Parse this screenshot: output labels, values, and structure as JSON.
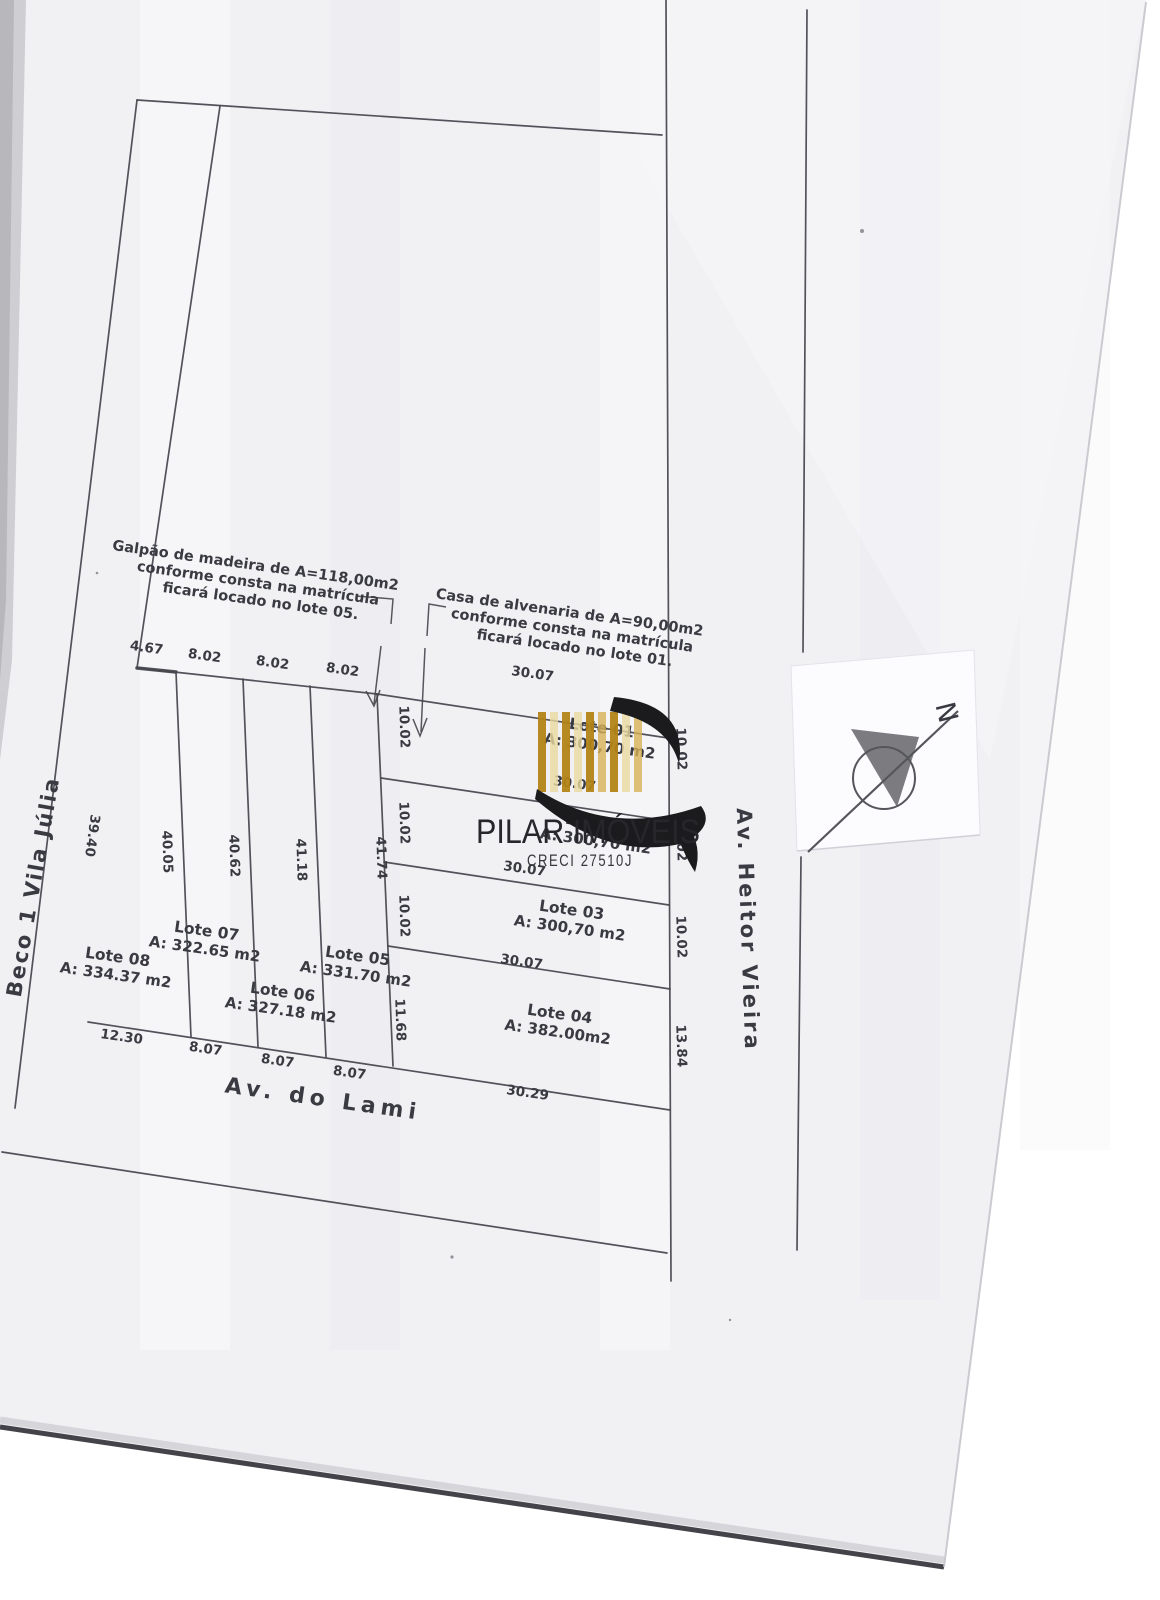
{
  "colors": {
    "paper": "#f1f1f4",
    "ink": "#45454d",
    "text_ink": "#3a3a42",
    "logo_black": "#1b1b1e",
    "gold_dark": "#b28316",
    "gold_mid": "#d7b258",
    "gold_pale": "#ead99f",
    "slip_white": "#fcfcff",
    "page_edge_dark": "#45434a",
    "compass_stroke": "#55555c"
  },
  "logo": {
    "title": "PILAR IMÓVEIS",
    "subtitle": "CRECI 27510J",
    "bar_colors": [
      "#b28316",
      "#ead99f",
      "#b28316",
      "#ead99f",
      "#b28316",
      "#d7b258",
      "#b28316",
      "#ead99f",
      "#d7b258"
    ]
  },
  "north": {
    "label": "N"
  },
  "streets": [
    {
      "id": "street-beco",
      "name": "Beco 1 Vila Júlia",
      "x": 40,
      "y": 888,
      "rot": -80,
      "size": 21,
      "ls": 2
    },
    {
      "id": "street-lami",
      "name": "Av. do Lami",
      "x": 322,
      "y": 1106,
      "rot": 8,
      "size": 22,
      "ls": 5
    },
    {
      "id": "street-heitor",
      "name": "Av. Heitor Vieira",
      "x": 741,
      "y": 930,
      "rot": 88,
      "size": 21,
      "ls": 3
    }
  ],
  "annotations": [
    {
      "id": "note-galpao",
      "lines": [
        "Galpão de madeira de A=118,00m2",
        "conforme consta na matrícula",
        "ficará locado no lote 05."
      ],
      "x": 255,
      "y": 570,
      "rot": 8,
      "size": 14.5
    },
    {
      "id": "note-casa",
      "lines": [
        "Casa de alvenaria de A=90,00m2",
        "conforme consta na matrícula",
        "ficará locado no lote 01."
      ],
      "x": 569,
      "y": 617,
      "rot": 8,
      "size": 14.5
    }
  ],
  "lots": [
    {
      "name": "Lote 01",
      "area": "A: 300,70 m2",
      "x": 601,
      "y": 733,
      "rot": 8
    },
    {
      "name": "Lote 02",
      "area": "A: 300,70 m2",
      "x": 597,
      "y": 828,
      "rot": 8
    },
    {
      "name": "Lote 03",
      "area": "A: 300,70 m2",
      "x": 571,
      "y": 915,
      "rot": 8
    },
    {
      "name": "Lote 04",
      "area": "A: 382.00m2",
      "x": 559,
      "y": 1019,
      "rot": 8
    },
    {
      "name": "Lote 05",
      "area": "A: 331.70 m2",
      "x": 357,
      "y": 961,
      "rot": 8
    },
    {
      "name": "Lote 06",
      "area": "A: 327.18 m2",
      "x": 282,
      "y": 997,
      "rot": 8
    },
    {
      "name": "Lote 07",
      "area": "A: 322.65 m2",
      "x": 206,
      "y": 936,
      "rot": 8
    },
    {
      "name": "Lote 08",
      "area": "A: 334.37 m2",
      "x": 117,
      "y": 962,
      "rot": 8
    }
  ],
  "measurements": [
    {
      "value": "4.67",
      "x": 146,
      "y": 652,
      "rot": 8
    },
    {
      "value": "8.02",
      "x": 204,
      "y": 660,
      "rot": 8
    },
    {
      "value": "8.02",
      "x": 272,
      "y": 667,
      "rot": 8
    },
    {
      "value": "8.02",
      "x": 342,
      "y": 674,
      "rot": 8
    },
    {
      "value": "30.07",
      "x": 532,
      "y": 678,
      "rot": 8
    },
    {
      "value": "30.07",
      "x": 574,
      "y": 788,
      "rot": 8
    },
    {
      "value": "30.07",
      "x": 524,
      "y": 873,
      "rot": 8
    },
    {
      "value": "30.07",
      "x": 521,
      "y": 966,
      "rot": 8
    },
    {
      "value": "30.29",
      "x": 527,
      "y": 1097,
      "rot": 8
    },
    {
      "value": "12.30",
      "x": 121,
      "y": 1041,
      "rot": 8
    },
    {
      "value": "8.07",
      "x": 205,
      "y": 1053,
      "rot": 8
    },
    {
      "value": "8.07",
      "x": 277,
      "y": 1065,
      "rot": 8
    },
    {
      "value": "8.07",
      "x": 349,
      "y": 1077,
      "rot": 8
    },
    {
      "value": "39.40",
      "x": 88,
      "y": 835,
      "rot": 98
    },
    {
      "value": "40.05",
      "x": 163,
      "y": 852,
      "rot": 88
    },
    {
      "value": "40.62",
      "x": 230,
      "y": 856,
      "rot": 88
    },
    {
      "value": "41.18",
      "x": 297,
      "y": 860,
      "rot": 88
    },
    {
      "value": "41.74",
      "x": 377,
      "y": 858,
      "rot": 88
    },
    {
      "value": "10.02",
      "x": 400,
      "y": 727,
      "rot": 88
    },
    {
      "value": "10.02",
      "x": 400,
      "y": 823,
      "rot": 88
    },
    {
      "value": "10.02",
      "x": 400,
      "y": 916,
      "rot": 88
    },
    {
      "value": "11.68",
      "x": 396,
      "y": 1020,
      "rot": 88
    },
    {
      "value": "10.02",
      "x": 677,
      "y": 749,
      "rot": 88
    },
    {
      "value": "10.02",
      "x": 677,
      "y": 840,
      "rot": 88
    },
    {
      "value": "10.02",
      "x": 677,
      "y": 937,
      "rot": 88
    },
    {
      "value": "13.84",
      "x": 677,
      "y": 1046,
      "rot": 88
    }
  ],
  "plan_lines": [
    {
      "pts": [
        137,
        100,
        662,
        135
      ]
    },
    {
      "pts": [
        137,
        100,
        15,
        1108
      ]
    },
    {
      "pts": [
        220,
        106,
        137,
        668
      ]
    },
    {
      "pts": [
        666,
        0,
        671,
        1281
      ]
    },
    {
      "pts": [
        807,
        10,
        803,
        652
      ]
    },
    {
      "pts": [
        801,
        857,
        797,
        1250
      ]
    },
    {
      "pts": [
        2,
        1152,
        667,
        1253
      ]
    },
    {
      "pts": [
        88,
        1022,
        670,
        1110
      ]
    },
    {
      "pts": [
        137,
        668,
        377,
        694
      ]
    },
    {
      "pts": [
        377,
        694,
        668,
        738
      ]
    },
    {
      "pts": [
        176,
        672,
        191,
        1037
      ]
    },
    {
      "pts": [
        243,
        679,
        258,
        1047
      ]
    },
    {
      "pts": [
        310,
        686,
        326,
        1057
      ]
    },
    {
      "pts": [
        377,
        694,
        393,
        1066
      ]
    },
    {
      "pts": [
        381,
        778,
        669,
        821
      ]
    },
    {
      "pts": [
        384,
        862,
        669,
        905
      ]
    },
    {
      "pts": [
        388,
        946,
        670,
        989
      ]
    },
    {
      "pts": [
        137,
        668,
        176,
        672
      ],
      "w": 3.5
    }
  ],
  "leaders": [
    {
      "id": "leader-galpao",
      "polys": [
        [
          356,
          596,
          393,
          599,
          391,
          624
        ],
        [
          381,
          646,
          374,
          704
        ],
        [
          366,
          691,
          374,
          706,
          380,
          690
        ]
      ]
    },
    {
      "id": "leader-casa",
      "polys": [
        [
          446,
          607,
          429,
          604,
          427,
          636
        ],
        [
          425,
          648,
          421,
          732
        ],
        [
          413,
          719,
          420,
          736,
          427,
          718
        ]
      ]
    }
  ]
}
